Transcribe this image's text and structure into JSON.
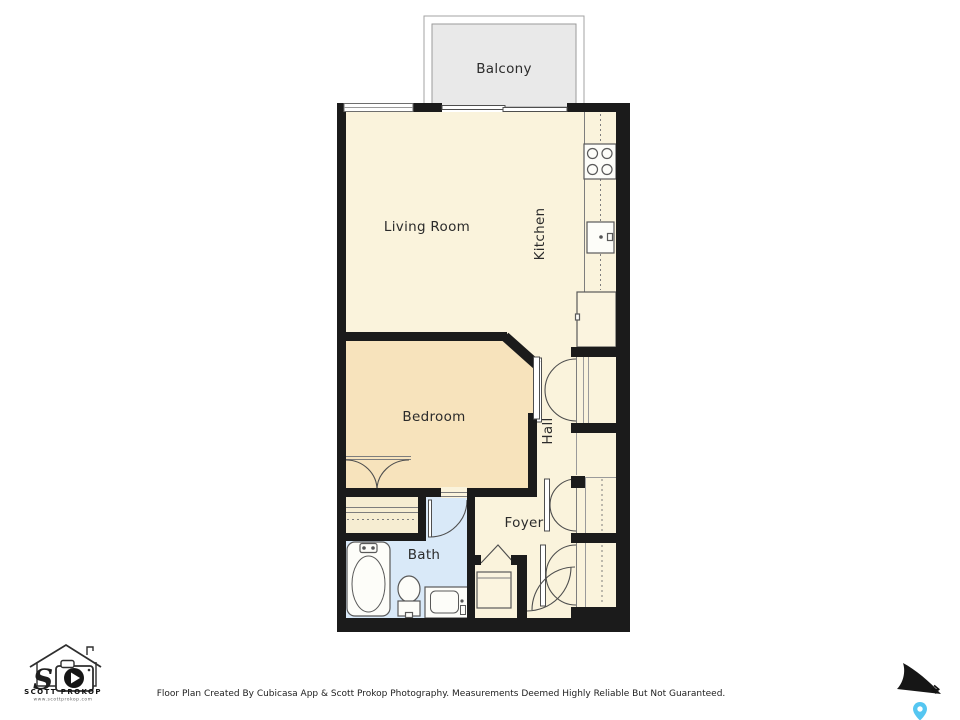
{
  "rooms": {
    "balcony": "Balcony",
    "living_room": "Living Room",
    "kitchen": "Kitchen",
    "bedroom": "Bedroom",
    "hall": "Hall",
    "foyer": "Foyer",
    "bath": "Bath"
  },
  "footer": {
    "disclaimer": "Floor Plan Created By Cubicasa App & Scott Prokop Photography. Measurements Deemed Highly Reliable But Not Guaranteed."
  },
  "logo": {
    "monogram": "S",
    "name": "SCOTT PROKOP",
    "website": "www.scottprokop.com"
  },
  "compass": {
    "north": "N"
  },
  "colors": {
    "wall": "#1B1B1B",
    "room": "#FAF3DC",
    "bedroom": "#F7E3BC",
    "storage": "#F6EDD2",
    "bath": "#D9E9F8",
    "balcony": "#E9E9E9",
    "pin": "#55C6F1"
  }
}
